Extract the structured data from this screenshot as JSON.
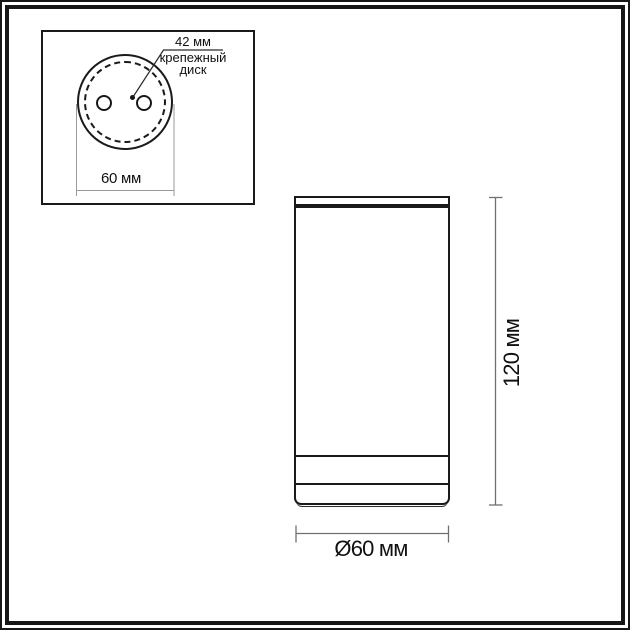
{
  "colors": {
    "outline": "#1a1a1a",
    "dimension_line": "#707070",
    "extension_line": "#9a9a9a",
    "background": "#ffffff"
  },
  "inset": {
    "callout_value": "42 мм",
    "callout_name_line1": "крепежный",
    "callout_name_line2": "диск",
    "width_label": "60 мм"
  },
  "main": {
    "height_label": "120 мм",
    "diameter_label": "Ø60 мм"
  }
}
